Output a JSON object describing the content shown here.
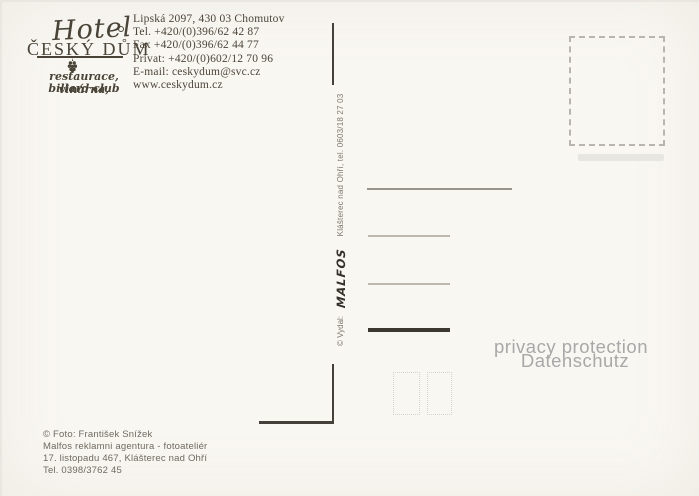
{
  "postcard": {
    "logo": {
      "script": "Hotel",
      "name": "ČESKÝ DŮM",
      "tagline1": "restaurace, vinárna,",
      "tagline2": "billard club"
    },
    "contact_lines": [
      "Lipská 2097, 430 03 Chomutov",
      "Tel. +420/(0)396/62 42 87",
      "Fax +420/(0)396/62 44 77",
      "Privat: +420/(0)602/12 70 96",
      "E-mail: ceskydum@svc.cz",
      "www.ceskydum.cz"
    ],
    "publisher": {
      "prefix": "© Vydal:",
      "name": "MALFOS",
      "location": "Klášterec nad Ohří, tel. 0603/18 27 03"
    },
    "credits_lines": [
      "© Foto: František Snížek",
      "Malfos reklamni agentura - fotoateliér",
      "17. listopadu 467, Klášterec nad Ohří",
      "Tel. 0398/3762 45"
    ],
    "privacy": {
      "line1": "privacy protection",
      "line2": "Datenschutz"
    },
    "icons": {
      "ornament": "grape-cluster-icon"
    },
    "colors": {
      "paper": "#f9f7f2",
      "ink": "#4a4438",
      "divider": "#45413a",
      "line_dark": "#3b3831",
      "line_light": "#bcb8b0",
      "stamp_dash": "#b8b5af",
      "privacy_text": "#a8a8a8",
      "credits_text": "#6e6a61"
    }
  }
}
